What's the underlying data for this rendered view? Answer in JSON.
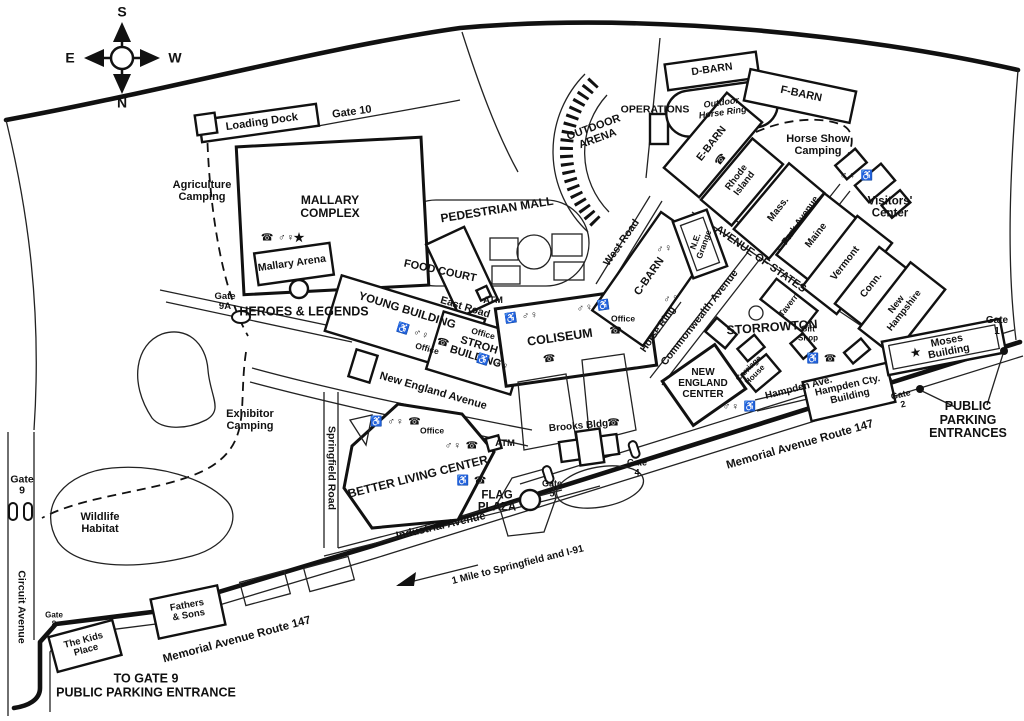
{
  "title": "Fairgrounds map",
  "compass": {
    "top": "S",
    "bottom": "N",
    "left": "E",
    "right": "W"
  },
  "icon_glyphs": {
    "star": "★",
    "phone": "☎",
    "accessible": "♿",
    "restrooms": "♂♀"
  },
  "labels": {
    "loading_dock": "Loading Dock",
    "gate_10": "Gate 10",
    "agriculture_camping": "Agriculture\nCamping",
    "mallary_complex": "MALLARY\nCOMPLEX",
    "mallary_arena": "Mallary Arena",
    "heroes_legends": "HEROES & LEGENDS",
    "gate_9a": "Gate\n9A",
    "pedestrian_mall": "PEDESTRIAN MALL",
    "food_court": "FOOD COURT",
    "east_road": "East Road",
    "atm_food_court": "ATM",
    "young_building": "YOUNG BUILDING",
    "office_young": "Office",
    "stroh_building": "STROH\nBUILDING",
    "office_stroh": "Office",
    "new_england_avenue": "New England Avenue",
    "outdoor_arena": "OUTDOOR\nARENA",
    "operations": "OPERATIONS",
    "d_barn": "D-BARN",
    "outdoor_horse_ring": "Outdoor\nHorse Ring",
    "f_barn": "F-BARN",
    "e_barn": "E-BARN",
    "rhode_island": "Rhode\nIsland",
    "mass": "Mass.",
    "horse_show_camping": "Horse Show\nCamping",
    "park_avenue": "Park Avenue",
    "visitors_center": "Visitors'\nCenter",
    "avenue_of_states": "AVENUE OF STATES",
    "maine": "Maine",
    "vermont": "Vermont",
    "conn": "Conn.",
    "new_hampshire": "New\nHampshire",
    "tavern": "Tavern",
    "gift_shop": "Gift\nShop",
    "storrowton": "STORROWTON",
    "carriage_house": "Carriage\nHouse",
    "new_england_center": "NEW\nENGLAND\nCENTER",
    "hampden_ave": "Hampden Ave.",
    "hampden_cty_building": "Hampden Cty.\nBuilding",
    "moses_building": "Moses Building",
    "gate_1": "Gate\n1",
    "gate_2": "Gate\n2",
    "public_parking_entrances": "PUBLIC PARKING\nENTRANCES",
    "memorial_ave_right": "Memorial Avenue Route 147",
    "memorial_ave_left": "Memorial Avenue Route 147",
    "west_road": "West Road",
    "c_barn": "C-BARN",
    "ne_grange": "N.E.\nGrange",
    "office_cbarn": "Office",
    "horse_ring": "Horse Ring",
    "commonwealth_avenue": "Commonwealth Avenue",
    "coliseum": "COLISEUM",
    "springfield_road": "Springfield Road",
    "exhibitor_camping": "Exhibitor\nCamping",
    "wildlife_habitat": "Wildlife\nHabitat",
    "gate_9": "Gate\n9",
    "circuit_avenue": "Circuit Avenue",
    "better_living_center": "BETTER LIVING CENTER",
    "office_blc": "Office",
    "atm_blc": "ATM",
    "industrial_avenue": "Industrial Avenue",
    "flag_plaza": "FLAG\nPLAZA",
    "brooks_bldg": "Brooks Bldg.",
    "gate_4": "Gate\n4",
    "gate_5": "Gate\n5",
    "gate_8": "Gate\n8",
    "kids_place": "The Kids\nPlace",
    "fathers_sons": "Fathers\n& Sons",
    "to_gate_9": "TO GATE 9\nPUBLIC PARKING ENTRANCE",
    "one_mile": "1 Mile to Springfield and I-91"
  },
  "amenities": {
    "mallary": "☎ ♂♀",
    "mallary_star": "★",
    "young": "♿ ♂♀",
    "young_office_phone": "☎",
    "stroh": "♿ ♂♀",
    "stroh_office_phone": "☎",
    "coliseum_w": "♿ ♂♀",
    "coliseum_e": "♂♀ ♿",
    "coliseum_phone": "☎",
    "cbarn_n": "♂♀",
    "cbarn_s": "♂♀",
    "cbarn_office_phone": "☎",
    "ebarn_phone": "☎",
    "blc_nw": "♿ ♂♀ ☎",
    "blc_e": "♂♀ ☎",
    "blc_s": "♿ ☎",
    "nec": "♂♀ ♿",
    "visitors": "♂♀ ♿",
    "storrowton": "♿ ☎",
    "brooks_phone": "☎",
    "moses_star": "★"
  }
}
